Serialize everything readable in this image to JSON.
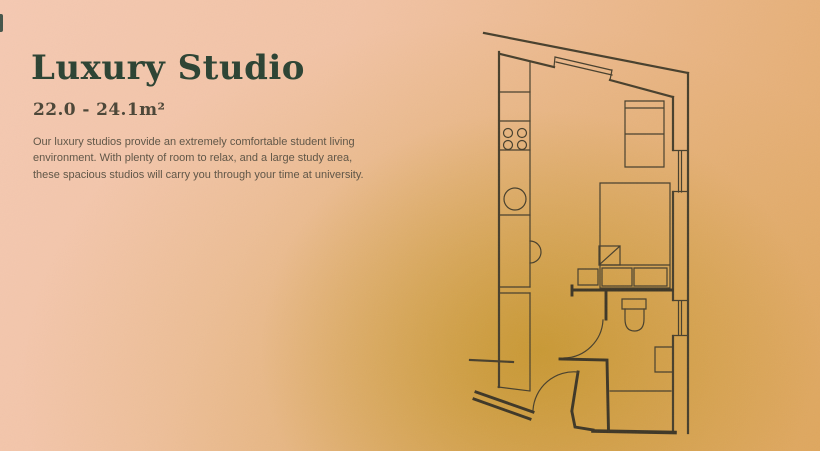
{
  "hero": {
    "title": "Luxury Studio",
    "area_range": "22.0 - 24.1m²",
    "description_lines": [
      "Our luxury studios provide an extremely comfortable student living",
      "environment. With plenty of room to relax, and a large study area,",
      "these spacious studios will carry you through your time at university."
    ]
  },
  "floorplan": {
    "name": "studio-floor-plan",
    "fixtures": [
      "top-window",
      "right-window-upper",
      "right-window-lower",
      "kitchen-counter",
      "kitchen-hob",
      "kitchen-sink",
      "wardrobe-unit",
      "desk",
      "bed",
      "duvet-fold",
      "pillows",
      "bedside-shelf",
      "partition-wall",
      "bathroom-door",
      "toilet",
      "wash-basin",
      "shower-area",
      "entry-door"
    ]
  },
  "colors": {
    "background_top_left": "#f5c9b2",
    "background_bottom_right": "#e2a966",
    "glow_gold": "#b48604",
    "plan_lines": "#473f2c",
    "title_text": "#2b4232",
    "area_text": "#4b4536",
    "body_text": "#5e5445",
    "edge_mark": "#254137"
  }
}
